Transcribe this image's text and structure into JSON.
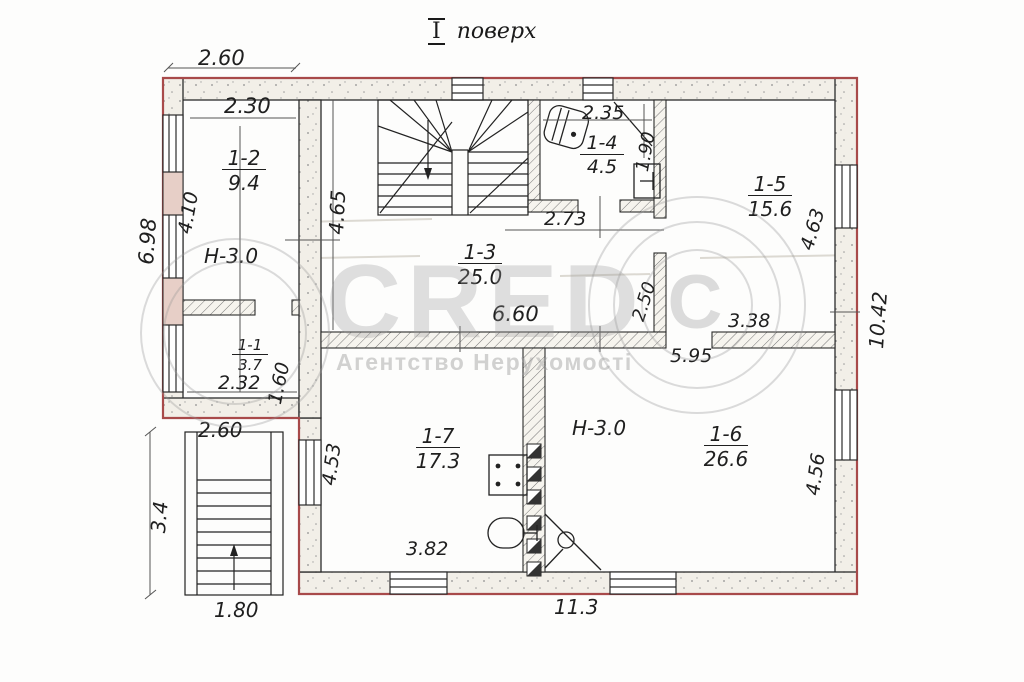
{
  "title": {
    "numeral": "І",
    "word": "поверх"
  },
  "watermark": {
    "brand": "СRED",
    "copyright": "С",
    "subtitle": "Агентство Нерухомості"
  },
  "rooms": [
    {
      "number": "1-2",
      "area": "9.4"
    },
    {
      "number": "1-1",
      "area": "3.7"
    },
    {
      "number": "1-3",
      "area": "25.0"
    },
    {
      "number": "1-4",
      "area": "4.5"
    },
    {
      "number": "1-5",
      "area": "15.6"
    },
    {
      "number": "1-7",
      "area": "17.3"
    },
    {
      "number": "1-6",
      "area": "26.6"
    }
  ],
  "height_labels": [
    {
      "text": "Н-3.0"
    },
    {
      "text": "Н-3.0"
    }
  ],
  "dimensions": [
    {
      "text": "2.60"
    },
    {
      "text": "2.30"
    },
    {
      "text": "6.98"
    },
    {
      "text": "4.10"
    },
    {
      "text": "2.32"
    },
    {
      "text": "1.60"
    },
    {
      "text": "2.60"
    },
    {
      "text": "3.4"
    },
    {
      "text": "1.80"
    },
    {
      "text": "4.65"
    },
    {
      "text": "2.35"
    },
    {
      "text": "1.90"
    },
    {
      "text": "2.73"
    },
    {
      "text": "6.60"
    },
    {
      "text": "2.50"
    },
    {
      "text": "3.38"
    },
    {
      "text": "5.95"
    },
    {
      "text": "4.63"
    },
    {
      "text": "10.42"
    },
    {
      "text": "4.53"
    },
    {
      "text": "3.82"
    },
    {
      "text": "4.56"
    },
    {
      "text": "11.3"
    }
  ]
}
